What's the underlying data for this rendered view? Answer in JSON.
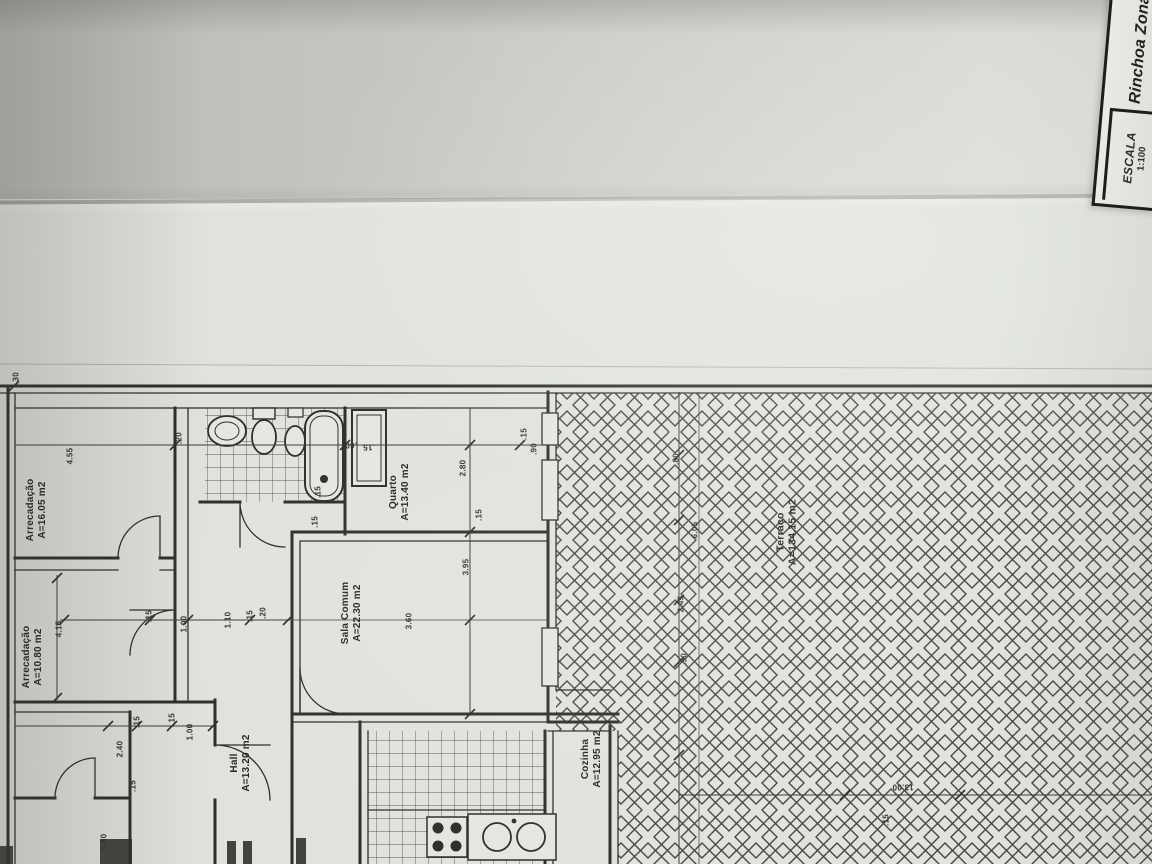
{
  "photo": {
    "description": "Folded photocopy of an architectural floor plan"
  },
  "title_block": {
    "scale_label": "ESCALA",
    "scale_value": "1:100",
    "location_value": "Rinchoa Zona"
  },
  "colors": {
    "paper": "#e0e3dc",
    "ink": "#2e2d28",
    "hatch": "#45453f",
    "dim": "#3c3b34"
  },
  "plan": {
    "rooms": [
      {
        "id": "arrecadacao-1",
        "name": "Arrecadação",
        "area": "A=16.05 m2",
        "x": 37,
        "y": 510,
        "rot": -90,
        "size": 10
      },
      {
        "id": "arrecadacao-2",
        "name": "Arrecadação",
        "area": "A=10.80 m2",
        "x": 33,
        "y": 657,
        "rot": -90,
        "size": 10
      },
      {
        "id": "hall",
        "name": "Hall",
        "area": "A=13.20 m2",
        "x": 241,
        "y": 763,
        "rot": -90,
        "size": 10
      },
      {
        "id": "sala-comum",
        "name": "Sala Comum",
        "area": "A=22.30 m2",
        "x": 352,
        "y": 613,
        "rot": -90,
        "size": 10
      },
      {
        "id": "quarto",
        "name": "Quarto",
        "area": "A=13.40 m2",
        "x": 400,
        "y": 492,
        "rot": -90,
        "size": 10
      },
      {
        "id": "cozinha",
        "name": "Cozinha",
        "area": "A=12.95 m2",
        "x": 592,
        "y": 759,
        "rot": -90,
        "size": 10
      },
      {
        "id": "terraco",
        "name": "Terraço",
        "area": "A=134.15 m2",
        "x": 787,
        "y": 532,
        "rot": -90,
        "size": 10.5
      }
    ],
    "dimensions": [
      {
        "t": ".30",
        "x": 16,
        "y": 378
      },
      {
        "t": "4.55",
        "x": 70,
        "y": 456
      },
      {
        "t": ".20",
        "x": 179,
        "y": 438
      },
      {
        "t": ".60",
        "x": 351,
        "y": 445,
        "r": 180
      },
      {
        "t": ".15",
        "x": 369,
        "y": 447,
        "r": 180
      },
      {
        "t": ".15",
        "x": 524,
        "y": 434
      },
      {
        "t": ".90",
        "x": 534,
        "y": 449
      },
      {
        "t": "2.80",
        "x": 463,
        "y": 468
      },
      {
        "t": ".15",
        "x": 479,
        "y": 515
      },
      {
        "t": "3.95",
        "x": 466,
        "y": 567
      },
      {
        "t": ".15",
        "x": 318,
        "y": 492
      },
      {
        "t": ".15",
        "x": 315,
        "y": 522
      },
      {
        "t": "3.60",
        "x": 409,
        "y": 621
      },
      {
        "t": "4.15",
        "x": 59,
        "y": 629
      },
      {
        "t": ".15",
        "x": 149,
        "y": 616
      },
      {
        "t": "1.00",
        "x": 184,
        "y": 624
      },
      {
        "t": "1.10",
        "x": 228,
        "y": 620
      },
      {
        "t": ".15",
        "x": 250,
        "y": 616
      },
      {
        "t": ".20",
        "x": 263,
        "y": 613
      },
      {
        "t": ".15",
        "x": 137,
        "y": 722
      },
      {
        "t": ".15",
        "x": 172,
        "y": 719
      },
      {
        "t": "2.40",
        "x": 120,
        "y": 749
      },
      {
        "t": "1.00",
        "x": 190,
        "y": 732
      },
      {
        "t": ".15",
        "x": 133,
        "y": 786
      },
      {
        "t": "1.60",
        "x": 104,
        "y": 842
      },
      {
        "t": ".80",
        "x": 676,
        "y": 459
      },
      {
        "t": "6.05",
        "x": 695,
        "y": 530
      },
      {
        "t": "2.45",
        "x": 681,
        "y": 604
      },
      {
        "t": ".50",
        "x": 684,
        "y": 659
      },
      {
        "t": "13.00",
        "x": 903,
        "y": 787,
        "r": 180
      },
      {
        "t": ".15",
        "x": 886,
        "y": 820
      }
    ]
  }
}
